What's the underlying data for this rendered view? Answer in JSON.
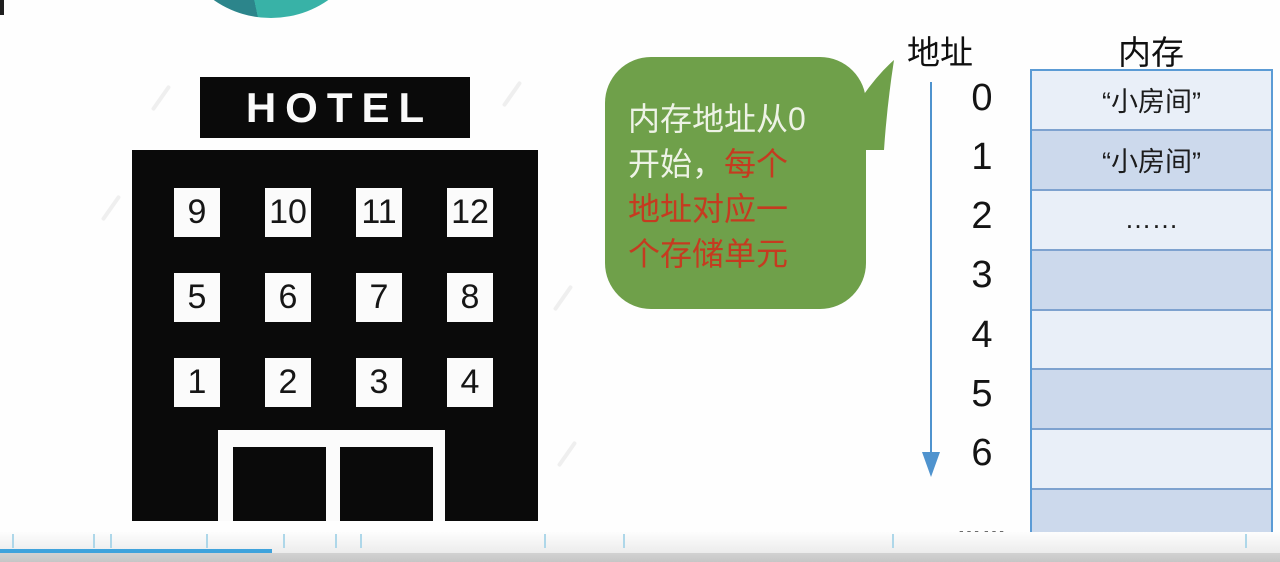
{
  "slide": {
    "hotel": {
      "sign": "HOTEL",
      "windows": [
        "9",
        "10",
        "11",
        "12",
        "5",
        "6",
        "7",
        "8",
        "1",
        "2",
        "3",
        "4"
      ]
    },
    "bubble": {
      "line1": "内存地址从0",
      "line2_normal": "开始，",
      "line2_highlight": "每个",
      "line3": "地址对应一",
      "line4": "个存储单元",
      "full_text": "内存地址从0开始，每个地址对应一个存储单元"
    },
    "address_column": {
      "header": "地址",
      "values": [
        "0",
        "1",
        "2",
        "3",
        "4",
        "5",
        "6"
      ],
      "ellipsis": "……"
    },
    "memory_column": {
      "header": "内存",
      "cells": [
        "“小房间”",
        "“小房间”",
        "……",
        "",
        "",
        "",
        "",
        ""
      ]
    }
  },
  "player": {
    "progress_fraction": 0.2125
  },
  "colors": {
    "bubble_green": "#6fa04a",
    "bubble_text_light": "#eef3e6",
    "bubble_text_red": "#c53b20",
    "cell_light": "#e9eff8",
    "cell_dark": "#ccd9ec",
    "table_border": "#5b9bd5",
    "arrow_blue": "#4f93ce",
    "progress_blue": "#3fa3dc",
    "circle_teal_dark": "#2c858b",
    "circle_teal_light": "#38b2a7"
  }
}
